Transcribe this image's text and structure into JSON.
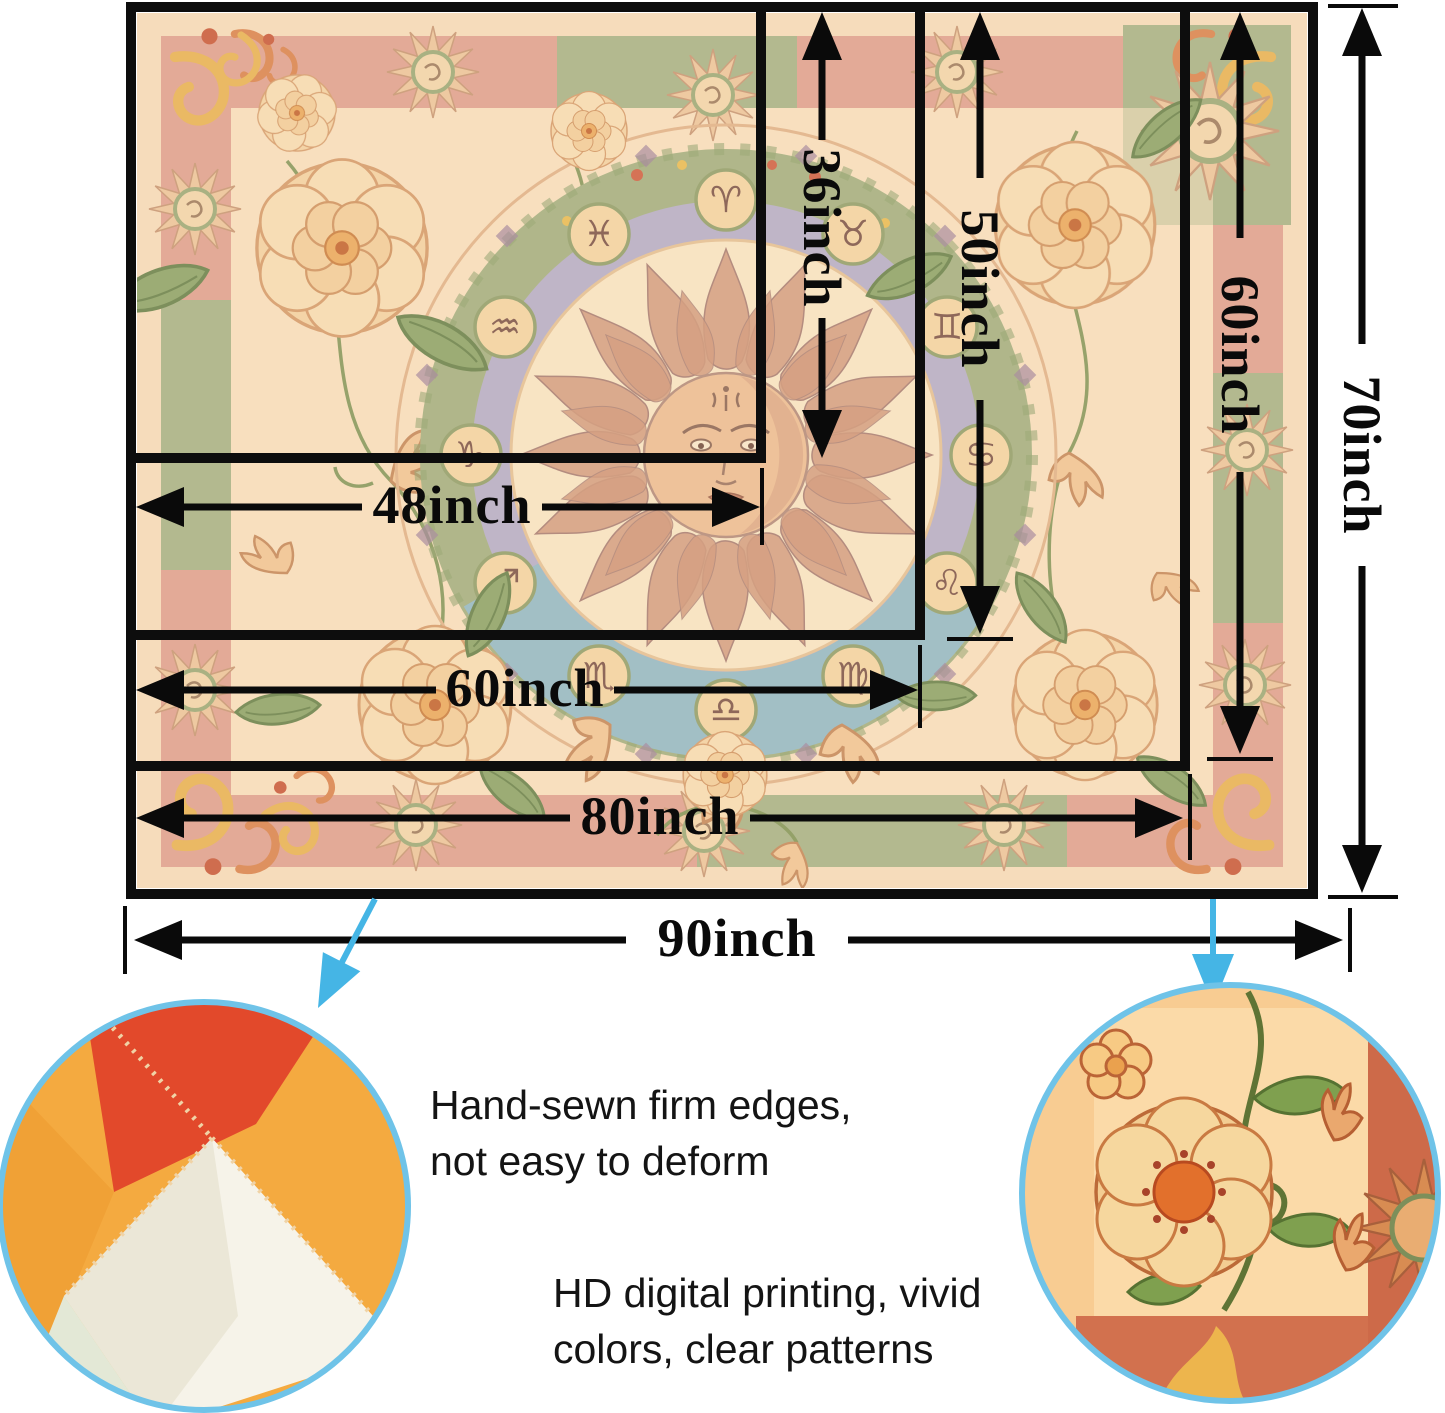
{
  "dimensions": {
    "v36": "36inch",
    "v50": "50inch",
    "v60": "60inch",
    "v70": "70inch",
    "h48": "48inch",
    "h60": "60inch",
    "h80": "80inch",
    "h90": "90inch"
  },
  "features": {
    "sewn": {
      "line1": "Hand-sewn firm edges,",
      "line2": "not easy to deform"
    },
    "print": {
      "line1": "HD digital printing, vivid",
      "line2": "colors, clear patterns"
    }
  },
  "art": {
    "zodiac": [
      "♈",
      "♉",
      "♊",
      "♋",
      "♌",
      "♍",
      "♎",
      "♏",
      "♐",
      "♑",
      "♒",
      "♓"
    ]
  },
  "colors": {
    "dimension_line": "#0a0a0a",
    "callout_blue": "#45b5e5",
    "tapestry_cream": "#f6dcbb",
    "band_salmon": "#dfa091",
    "wreath_green": "#a2af81",
    "ring_lavender": "#b4adca",
    "ring_blue": "#92b9c8",
    "sun_terracotta": "#d5a186"
  }
}
